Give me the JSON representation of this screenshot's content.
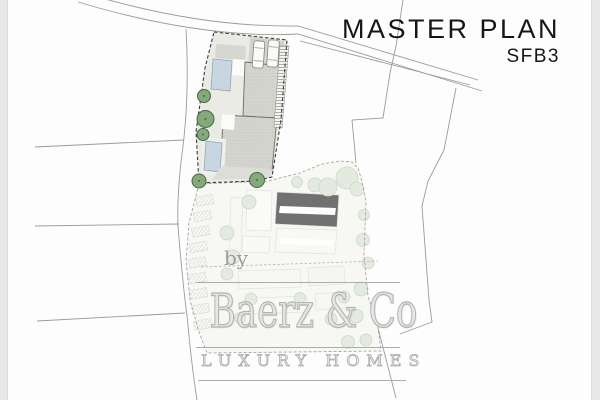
{
  "header": {
    "title": "MASTER PLAN",
    "subtitle": "SFB3"
  },
  "watermark": {
    "prefix": "by",
    "brand": "Baerz & Co",
    "tagline": "LUXURY HOMES"
  },
  "colors": {
    "paper": "#fdfdfd",
    "edge": "#e8e8e8",
    "line": "#9b9b9b",
    "boundary": "#3c3c3c",
    "plot-fill": "#ebebe5",
    "roof-fill": "#d9d9d3",
    "pool": "#c8d6e2",
    "tree-dark": "#85a87d",
    "tree-light": "#cfdbc8",
    "faded-fill": "#f3f3ed",
    "text": "#161616",
    "watermark": "#b0b0b0"
  }
}
